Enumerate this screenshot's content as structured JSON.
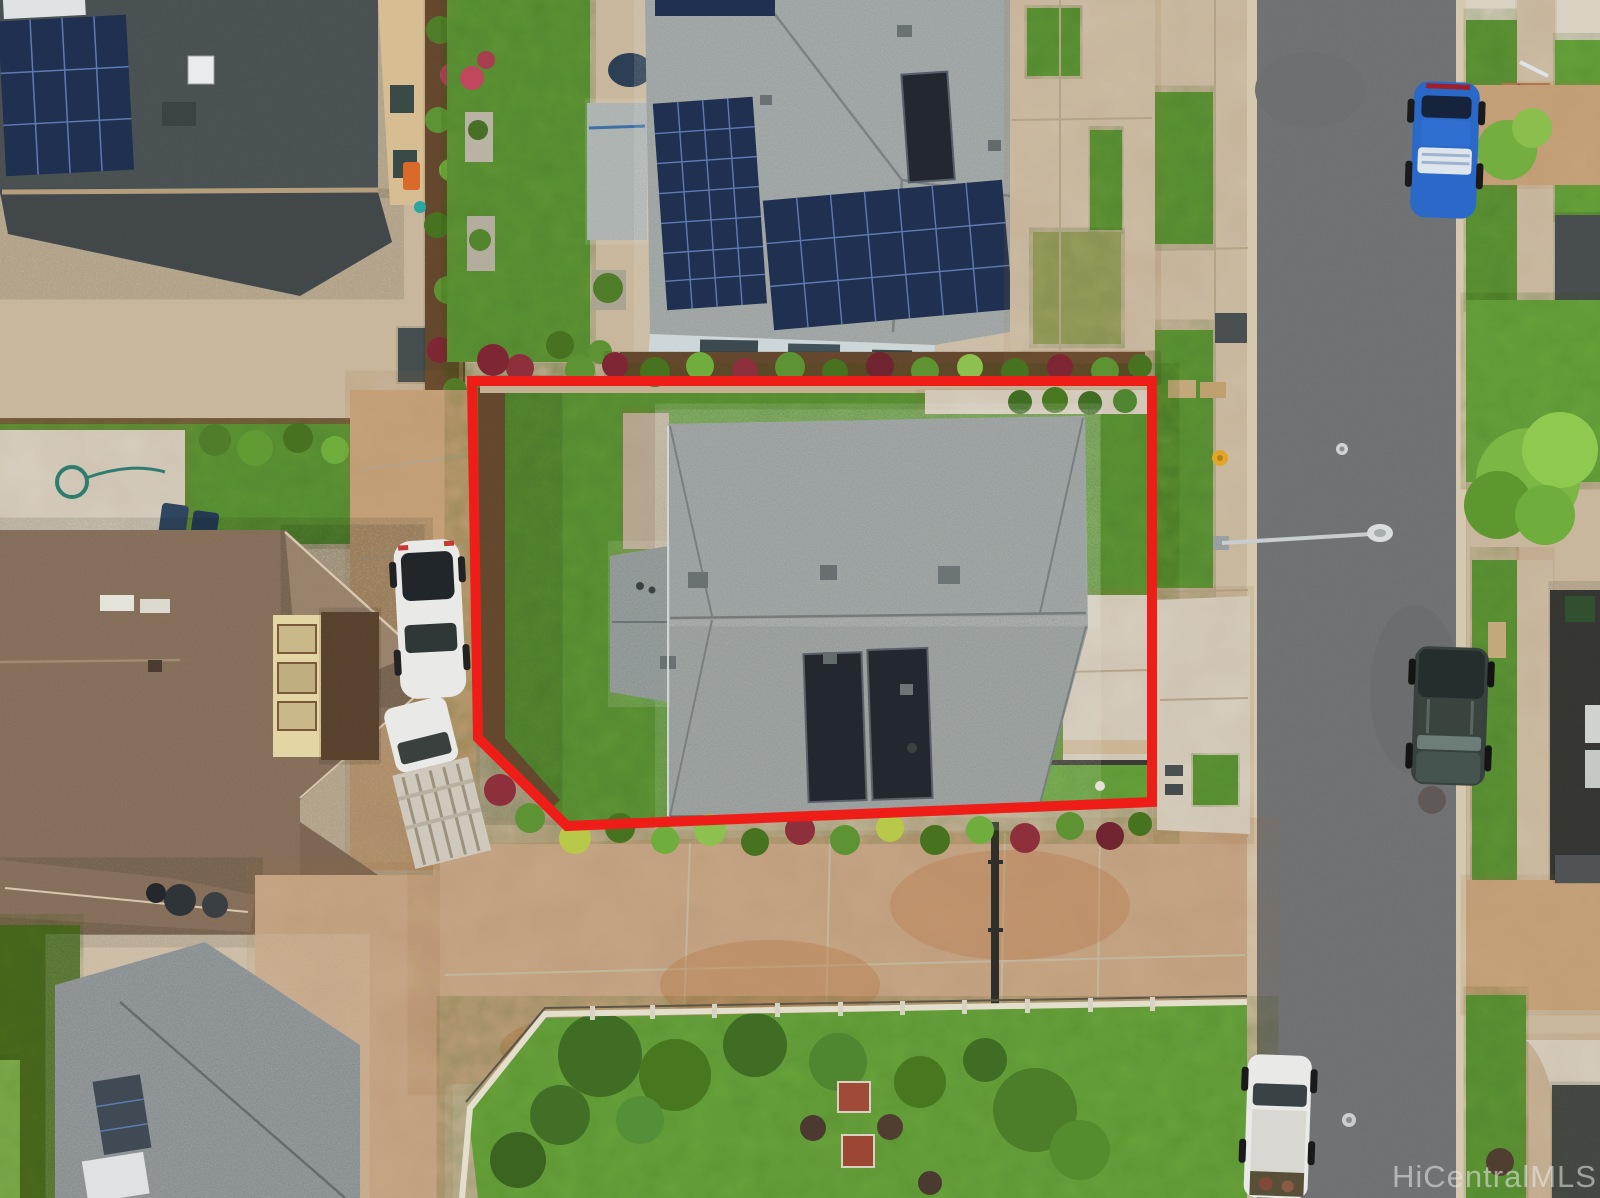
{
  "image": {
    "kind": "aerial-drone-photo",
    "subject": "residential lot outlined in red, suburban neighborhood, top-down view",
    "width_px": 1600,
    "height_px": 1198
  },
  "watermark": {
    "text": "HiCentralMLS"
  },
  "boundary": {
    "label": "subject-property-boundary",
    "color": "#ee1d17"
  },
  "scene_objects": [
    "subject house with gray shingle hip roof and two rooftop solar water panels",
    "red property line around lawn and house",
    "neighbor house above with large blue photovoltaic arrays",
    "neighbor house left with brown hip roof",
    "neighbor house bottom-left with gray roof and solar panel",
    "shared concrete driveway with rust stains",
    "back lawn with shrubs and stepping stones behind low fence",
    "asphalt street running vertically on right",
    "blue sedan parked at right curb",
    "dark SUV parked at right curb",
    "white pickup truck parked at left curb bottom",
    "white SUV and white flatbed work truck parked in left driveway",
    "street light arm over roadway",
    "sidewalks, grass parking strips, fire hydrant, utility boxes",
    "tropical shrub rows with red ti plants along property line"
  ],
  "colors": {
    "asphalt": "#77787a",
    "curb": "#d6c8ae",
    "sidewalk": "#cec0a7",
    "concrete_light": "#d9d2c2",
    "driveway_tan": "#c8a57e",
    "driveway_big": "#c7a887",
    "lawn": "#5f9637",
    "lawn_bright": "#69a53c",
    "turf_dark": "#4c6a21",
    "mulch": "#6b4e33",
    "roof_subject": "#8a9190",
    "roof_top": "#929998",
    "roof_top_left": "#4f5759",
    "roof_brown": "#8e7660",
    "roof_bottom_left": "#7a8184",
    "solar_panel": "#1f3050",
    "boundary_red": "#ee1d17",
    "car_blue": "#2a69c8",
    "suv_dark": "#37423f",
    "vehicle_white": "#e9eae7",
    "fence_light": "#e4decd",
    "water_heater": "#23282e",
    "stone_dark": "#4e5254"
  }
}
